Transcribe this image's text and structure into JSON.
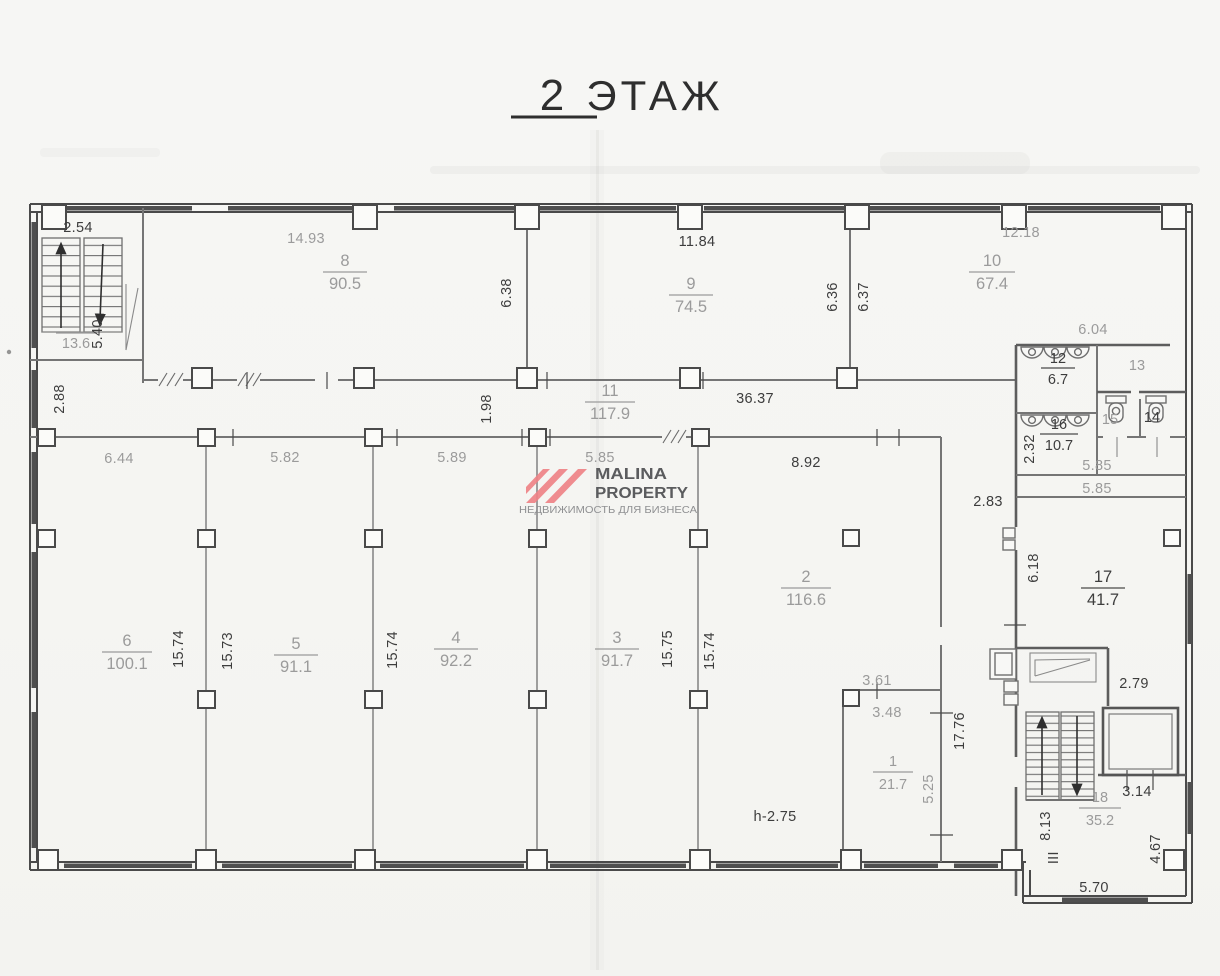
{
  "title": {
    "num": "2",
    "word": "ЭТАЖ"
  },
  "watermark": {
    "brand_line1": "MALINA",
    "brand_line2": "PROPERTY",
    "tagline": "НЕДВИЖИМОСТЬ ДЛЯ БИЗНЕСА",
    "colors": {
      "logo": "#ee8287",
      "brand_text": "#5b5c5e",
      "tagline_text": "#8f9092"
    }
  },
  "rooms": {
    "r1": {
      "num": "1",
      "area": "21.7"
    },
    "r2": {
      "num": "2",
      "area": "116.6"
    },
    "r3": {
      "num": "3",
      "area": "91.7"
    },
    "r4": {
      "num": "4",
      "area": "92.2"
    },
    "r5": {
      "num": "5",
      "area": "91.1"
    },
    "r6": {
      "num": "6",
      "area": "100.1"
    },
    "r8": {
      "num": "8",
      "area": "90.5"
    },
    "r9": {
      "num": "9",
      "area": "74.5"
    },
    "r10": {
      "num": "10",
      "area": "67.4"
    },
    "r11": {
      "num": "11",
      "area": "117.9"
    },
    "r12": {
      "num": "12",
      "area": "6.7"
    },
    "r13": {
      "num": "13"
    },
    "r14": {
      "num": "14"
    },
    "r15": {
      "num": "15"
    },
    "r16": {
      "num": "16",
      "area": "10.7"
    },
    "r17": {
      "num": "17",
      "area": "41.7"
    },
    "r18": {
      "num": "18",
      "area": "35.2"
    },
    "stairwell_area": "13.6"
  },
  "dims": {
    "d2_54": "2.54",
    "d14_93": "14.93",
    "d11_84": "11.84",
    "d12_18": "12.18",
    "d6_38": "6.38",
    "d6_36": "6.36",
    "d6_37": "6.37",
    "d5_40": "5.40",
    "d2_88": "2.88",
    "d1_98": "1.98",
    "d36_37": "36.37",
    "d6_04": "6.04",
    "d2_32": "2.32",
    "d5_85_a": "5.85",
    "d5_85_b": "5.85",
    "d5_85_c": "5.85",
    "d6_44": "6.44",
    "d5_82": "5.82",
    "d5_89": "5.89",
    "d8_92": "8.92",
    "d2_83": "2.83",
    "d6_18": "6.18",
    "d15_74_a": "15.74",
    "d15_73": "15.73",
    "d15_74_b": "15.74",
    "d15_75": "15.75",
    "d15_74_c": "15.74",
    "d3_61": "3.61",
    "d3_48": "3.48",
    "d17_76": "17.76",
    "d5_25": "5.25",
    "dh_2_75": "h-2.75",
    "d8_13": "8.13",
    "d_iii": "III",
    "d3_14": "3.14",
    "d2_79": "2.79",
    "d4_67": "4.67",
    "d5_70": "5.70"
  }
}
